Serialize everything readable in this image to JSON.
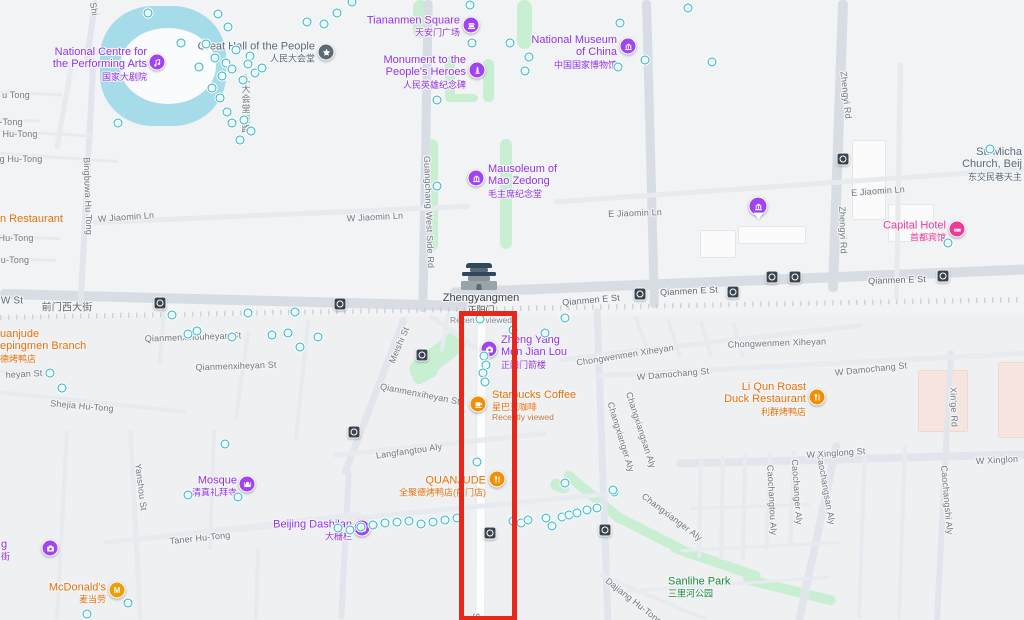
{
  "annotation": {
    "type": "highlight-rectangle",
    "x": 459,
    "y": 311,
    "width": 48,
    "height": 300,
    "color": "#e8271b",
    "thickness": 5
  },
  "colors": {
    "purple_text": "#9334e6",
    "purple_icon": "#a044f2",
    "orange_text": "#e8710a",
    "orange_icon": "#f09004",
    "pink_text": "#ee3a9e",
    "pink_icon": "#ec3a96",
    "green_text": "#1c8a3c",
    "grey_poi": "#3d4348",
    "church_grey": "#5a6a78",
    "street_grey": "#71787f",
    "teal_dot": "#2fb2c3",
    "transit": "#39444f",
    "water": "#a6dbe9",
    "park": "#c9efd3",
    "road_major": "#d8dde4"
  },
  "pois": [
    {
      "id": "ncpa",
      "lines": [
        "National Centre for",
        "the Performing Arts"
      ],
      "cn": "国家大剧院",
      "note": null,
      "icon": "music",
      "color": "#a044f2",
      "text_color": "#9334e6",
      "side": "left",
      "ix": 157,
      "iy": 62,
      "lx": 147,
      "ly": 64
    },
    {
      "id": "great-hall",
      "lines": [
        "Great Hall of the People"
      ],
      "cn": "人民大会堂",
      "note": null,
      "icon": "star",
      "color": "#5c6a73",
      "text_color": "#5a6a78",
      "side": "left",
      "ix": 326,
      "iy": 52,
      "lx": 315,
      "ly": 52
    },
    {
      "id": "tiananmen-square",
      "lines": [
        "Tiananmen Square"
      ],
      "cn": "天安门广场",
      "note": null,
      "icon": "landmark",
      "color": "#a044f2",
      "text_color": "#9334e6",
      "side": "left",
      "ix": 471,
      "iy": 25,
      "lx": 460,
      "ly": 26
    },
    {
      "id": "monument-peoples-heroes",
      "lines": [
        "Monument to the",
        "People's Heroes"
      ],
      "cn": "人民英雄纪念碑",
      "note": null,
      "icon": "monument",
      "color": "#a044f2",
      "text_color": "#9334e6",
      "side": "left",
      "ix": 477,
      "iy": 70,
      "lx": 466,
      "ly": 72
    },
    {
      "id": "national-museum",
      "lines": [
        "National Museum",
        "of China"
      ],
      "cn": "中国国家博物馆",
      "note": null,
      "icon": "museum",
      "color": "#a044f2",
      "text_color": "#9334e6",
      "side": "left",
      "ix": 628,
      "iy": 46,
      "lx": 617,
      "ly": 52
    },
    {
      "id": "mausoleum-mao-zedong",
      "lines": [
        "Mausoleum of",
        "Mao Zedong"
      ],
      "cn": "毛主席纪念堂",
      "note": null,
      "icon": "museum",
      "color": "#a044f2",
      "text_color": "#9334e6",
      "side": "right",
      "ix": 476,
      "iy": 178,
      "lx": 488,
      "ly": 181
    },
    {
      "id": "zhengyangmen",
      "lines": [
        "Zhengyangmen"
      ],
      "cn": "正阳门",
      "note": "Recently viewed",
      "icon": "gate",
      "color": "#33475a",
      "text_color": "#3d4348",
      "note_color": "#82898f",
      "side": "below",
      "ix": 479,
      "iy": 277,
      "lx": 481,
      "ly": 292
    },
    {
      "id": "chengyangmen-jianlou",
      "lines": [
        "Zheng Yang",
        "Men Jian Lou"
      ],
      "cn": "正阳门箭楼",
      "note": null,
      "icon": "camera",
      "color": "#a044f2",
      "text_color": "#9334e6",
      "side": "right",
      "ix": 489,
      "iy": 349,
      "lx": 501,
      "ly": 352
    },
    {
      "id": "starbucks",
      "lines": [
        "Starbucks Coffee"
      ],
      "cn": "星巴克咖啡",
      "note": "Recently viewed",
      "icon": "coffee",
      "color": "#f09004",
      "text_color": "#e8710a",
      "note_color": "#c07a3d",
      "side": "right",
      "ix": 478,
      "iy": 404,
      "lx": 492,
      "ly": 406
    },
    {
      "id": "quanjude-qianmen",
      "lines": [
        "QUANJUDE"
      ],
      "cn": "全聚德烤鸭店(前门店)",
      "note": null,
      "icon": "restaurant",
      "color": "#f09004",
      "text_color": "#e8710a",
      "side": "left",
      "ix": 497,
      "iy": 479,
      "lx": 486,
      "ly": 486
    },
    {
      "id": "liqun-roast-duck",
      "lines": [
        "Li Qun Roast",
        "Duck Restaurant"
      ],
      "cn": "利群烤鸭店",
      "note": null,
      "icon": "restaurant",
      "color": "#f09004",
      "text_color": "#e8710a",
      "side": "left",
      "ix": 817,
      "iy": 397,
      "lx": 806,
      "ly": 399
    },
    {
      "id": "capital-hotel",
      "lines": [
        "Capital Hotel"
      ],
      "cn": "首都宾馆",
      "note": null,
      "icon": "hotel",
      "color": "#ec3a96",
      "text_color": "#ee3a9e",
      "side": "left",
      "ix": 957,
      "iy": 229,
      "lx": 946,
      "ly": 231
    },
    {
      "id": "st-michaels-church",
      "lines": [
        "St. Micha",
        "Church, Beij"
      ],
      "cn": "东交民巷天主",
      "note": null,
      "icon": null,
      "color": null,
      "text_color": "#5a6a78",
      "side": "left",
      "ix": null,
      "iy": null,
      "lx": 1022,
      "ly": 164
    },
    {
      "id": "mosque",
      "lines": [
        "Mosque"
      ],
      "cn": "清真礼拜寺",
      "note": null,
      "icon": "mosque",
      "color": "#a044f2",
      "text_color": "#9334e6",
      "side": "left",
      "ix": 247,
      "iy": 484,
      "lx": 237,
      "ly": 486
    },
    {
      "id": "beijing-dashilan",
      "lines": [
        "Beijing Dashilan"
      ],
      "cn": "大栅栏",
      "note": null,
      "icon": "camera",
      "color": "#a044f2",
      "text_color": "#9334e6",
      "side": "left",
      "ix": 362,
      "iy": 528,
      "lx": 352,
      "ly": 530
    },
    {
      "id": "mcdonalds",
      "lines": [
        "McDonald's"
      ],
      "cn": "麦当劳",
      "note": null,
      "icon": "mcdonalds",
      "color": "#f09e06",
      "text_color": "#e8710a",
      "side": "left",
      "ix": 117,
      "iy": 590,
      "lx": 106,
      "ly": 593
    },
    {
      "id": "sanlihe-park",
      "lines": [
        "Sanlihe Park"
      ],
      "cn": "三里河公园",
      "note": null,
      "icon": null,
      "color": null,
      "text_color": "#1c8a3c",
      "side": "right",
      "ix": null,
      "iy": null,
      "lx": 668,
      "ly": 587
    },
    {
      "id": "quanjude-hepingmen",
      "lines": [
        "uanjude",
        "epingmen Branch"
      ],
      "cn": "德烤鸭店",
      "note": null,
      "icon": null,
      "color": null,
      "text_color": "#e8710a",
      "side": "right",
      "ix": null,
      "iy": null,
      "lx": 0,
      "ly": 346
    },
    {
      "id": "restaurant-partial",
      "lines": [
        "n Restaurant"
      ],
      "cn": null,
      "note": null,
      "icon": null,
      "color": null,
      "text_color": "#e8710a",
      "side": "right",
      "ix": null,
      "iy": null,
      "lx": 0,
      "ly": 219
    },
    {
      "id": "museum-pin",
      "lines": [],
      "cn": null,
      "note": null,
      "icon": "pin-museum",
      "color": "#a044f2",
      "text_color": null,
      "side": "none",
      "ix": 758,
      "iy": 208,
      "lx": 0,
      "ly": 0
    },
    {
      "id": "poi-partial-left",
      "lines": [
        "g"
      ],
      "cn": "街",
      "note": null,
      "icon": "camera",
      "color": "#a044f2",
      "text_color": "#9334e6",
      "side": "right",
      "ix": 50,
      "iy": 548,
      "lx": 1,
      "ly": 550
    }
  ],
  "street_labels": [
    {
      "text": "u Tong",
      "x": 16,
      "y": 95,
      "rot": 0
    },
    {
      "text": "-Tong",
      "x": 11,
      "y": 122,
      "rot": 0
    },
    {
      "text": "Hu-Tong",
      "x": 20,
      "y": 134,
      "rot": 0
    },
    {
      "text": "g Hu-Tong",
      "x": 21,
      "y": 159,
      "rot": 0
    },
    {
      "text": "Hu-Tong",
      "x": 16,
      "y": 238,
      "rot": 0
    },
    {
      "text": "u-Tong",
      "x": 15,
      "y": 260,
      "rot": 0
    },
    {
      "text": "Shi",
      "x": 94,
      "y": 9,
      "rot": 80
    },
    {
      "text": "Bingbuwa Hu Tong",
      "x": 88,
      "y": 196,
      "rot": 88
    },
    {
      "text": "人大会堂西路",
      "x": 246,
      "y": 104,
      "rot": 0,
      "cjkv": true
    },
    {
      "text": "W Jiaomin Ln",
      "x": 126,
      "y": 217,
      "rot": -4
    },
    {
      "text": "W Jiaomin Ln",
      "x": 375,
      "y": 217,
      "rot": -3
    },
    {
      "text": "E Jiaomin Ln",
      "x": 635,
      "y": 213,
      "rot": -2
    },
    {
      "text": "E Jiaomin Ln",
      "x": 878,
      "y": 191,
      "rot": -4
    },
    {
      "text": "W St",
      "x": 12,
      "y": 301,
      "rot": 0,
      "color": "#626a71",
      "size": 10
    },
    {
      "text": "前门西大街",
      "x": 67,
      "y": 306,
      "rot": 0,
      "color": "#626a71",
      "size": 10
    },
    {
      "text": "Qianmen E St",
      "x": 591,
      "y": 300,
      "rot": -5,
      "color": "#626a71"
    },
    {
      "text": "Qianmen E St",
      "x": 689,
      "y": 291,
      "rot": -3,
      "color": "#626a71"
    },
    {
      "text": "Qianmen E St",
      "x": 897,
      "y": 280,
      "rot": -2,
      "color": "#626a71"
    },
    {
      "text": "Guangchang West Side Rd",
      "x": 429,
      "y": 212,
      "rot": 88
    },
    {
      "text": "Zhengyi Rd",
      "x": 846,
      "y": 95,
      "rot": 84
    },
    {
      "text": "Zhengyi Rd",
      "x": 843,
      "y": 230,
      "rot": 88
    },
    {
      "text": "Meishi St",
      "x": 399,
      "y": 345,
      "rot": -67
    },
    {
      "text": "Qianmenxihouheyan St",
      "x": 193,
      "y": 337,
      "rot": -2
    },
    {
      "text": "Qianmenxiheyan St",
      "x": 236,
      "y": 366,
      "rot": -2
    },
    {
      "text": "Qianmenxiheyan St",
      "x": 420,
      "y": 394,
      "rot": 11
    },
    {
      "text": "heyan St",
      "x": 24,
      "y": 374,
      "rot": -3
    },
    {
      "text": "Shejia Hu-Tong",
      "x": 82,
      "y": 406,
      "rot": 5
    },
    {
      "text": "Langfangtou Aly",
      "x": 409,
      "y": 451,
      "rot": -8
    },
    {
      "text": "Chongwenmen Xiheyan",
      "x": 625,
      "y": 355,
      "rot": -9
    },
    {
      "text": "Chongwenmen Xiheyan",
      "x": 777,
      "y": 343,
      "rot": -2
    },
    {
      "text": "W Damochang St",
      "x": 673,
      "y": 374,
      "rot": -5
    },
    {
      "text": "W Damochang St",
      "x": 871,
      "y": 369,
      "rot": -6
    },
    {
      "text": "Changxianger Aly",
      "x": 621,
      "y": 437,
      "rot": 73
    },
    {
      "text": "Changxiangsan Aly",
      "x": 641,
      "y": 430,
      "rot": 72
    },
    {
      "text": "Changxianger Aly",
      "x": 672,
      "y": 517,
      "rot": 37
    },
    {
      "text": "Caochangtou Aly",
      "x": 772,
      "y": 500,
      "rot": 87
    },
    {
      "text": "Caochanger Aly",
      "x": 797,
      "y": 492,
      "rot": 86
    },
    {
      "text": "Caochangsan Aly",
      "x": 826,
      "y": 489,
      "rot": 80
    },
    {
      "text": "Caochangshi Aly",
      "x": 947,
      "y": 500,
      "rot": 85
    },
    {
      "text": "Xin'ge Rd",
      "x": 954,
      "y": 407,
      "rot": 88
    },
    {
      "text": "W Xinglong St",
      "x": 836,
      "y": 453,
      "rot": -4
    },
    {
      "text": "W Xinglon",
      "x": 997,
      "y": 460,
      "rot": -3
    },
    {
      "text": "Yanshou St",
      "x": 141,
      "y": 487,
      "rot": 83
    },
    {
      "text": "Taner Hu-Tong",
      "x": 200,
      "y": 538,
      "rot": -6
    },
    {
      "text": "Dajiang Hu-Tong",
      "x": 634,
      "y": 601,
      "rot": 38
    },
    {
      "text": "S",
      "x": 476,
      "y": 616,
      "rot": 90
    }
  ],
  "transit_stations": [
    [
      160,
      303
    ],
    [
      340,
      304
    ],
    [
      422,
      355
    ],
    [
      354,
      432
    ],
    [
      490,
      533
    ],
    [
      605,
      530
    ],
    [
      640,
      294
    ],
    [
      733,
      292
    ],
    [
      772,
      277
    ],
    [
      795,
      277
    ],
    [
      843,
      159
    ],
    [
      943,
      276
    ]
  ],
  "poi_dots": [
    [
      218,
      14
    ],
    [
      228,
      27
    ],
    [
      206,
      44
    ],
    [
      215,
      58
    ],
    [
      236,
      50
    ],
    [
      250,
      56
    ],
    [
      226,
      63
    ],
    [
      248,
      64
    ],
    [
      222,
      76
    ],
    [
      232,
      69
    ],
    [
      243,
      80
    ],
    [
      255,
      73
    ],
    [
      262,
      68
    ],
    [
      220,
      98
    ],
    [
      227,
      112
    ],
    [
      244,
      120
    ],
    [
      251,
      131
    ],
    [
      232,
      123
    ],
    [
      181,
      43
    ],
    [
      199,
      67
    ],
    [
      212,
      88
    ],
    [
      240,
      140
    ],
    [
      118,
      123
    ],
    [
      148,
      13
    ],
    [
      307,
      22
    ],
    [
      324,
      24
    ],
    [
      337,
      13
    ],
    [
      352,
      2
    ],
    [
      470,
      5
    ],
    [
      472,
      43
    ],
    [
      510,
      43
    ],
    [
      529,
      57
    ],
    [
      525,
      71
    ],
    [
      437,
      100
    ],
    [
      620,
      23
    ],
    [
      618,
      67
    ],
    [
      645,
      60
    ],
    [
      437,
      186
    ],
    [
      688,
      8
    ],
    [
      712,
      62
    ],
    [
      480,
      319
    ],
    [
      545,
      333
    ],
    [
      565,
      318
    ],
    [
      513,
      330
    ],
    [
      484,
      356
    ],
    [
      486,
      365
    ],
    [
      483,
      373
    ],
    [
      485,
      382
    ],
    [
      172,
      315
    ],
    [
      188,
      334
    ],
    [
      197,
      331
    ],
    [
      232,
      337
    ],
    [
      62,
      388
    ],
    [
      50,
      373
    ],
    [
      272,
      335
    ],
    [
      288,
      333
    ],
    [
      318,
      337
    ],
    [
      300,
      347
    ],
    [
      295,
      312
    ],
    [
      248,
      313
    ],
    [
      338,
      528
    ],
    [
      350,
      530
    ],
    [
      361,
      527
    ],
    [
      373,
      525
    ],
    [
      385,
      523
    ],
    [
      397,
      522
    ],
    [
      409,
      521
    ],
    [
      421,
      524
    ],
    [
      433,
      522
    ],
    [
      445,
      520
    ],
    [
      457,
      518
    ],
    [
      513,
      521
    ],
    [
      521,
      523
    ],
    [
      528,
      520
    ],
    [
      546,
      518
    ],
    [
      552,
      526
    ],
    [
      562,
      517
    ],
    [
      569,
      515
    ],
    [
      577,
      513
    ],
    [
      587,
      510
    ],
    [
      597,
      508
    ],
    [
      614,
      492
    ],
    [
      477,
      462
    ],
    [
      565,
      483
    ],
    [
      613,
      490
    ],
    [
      188,
      495
    ],
    [
      238,
      497
    ],
    [
      225,
      444
    ],
    [
      128,
      603
    ],
    [
      87,
      614
    ],
    [
      948,
      243
    ],
    [
      990,
      149
    ]
  ]
}
